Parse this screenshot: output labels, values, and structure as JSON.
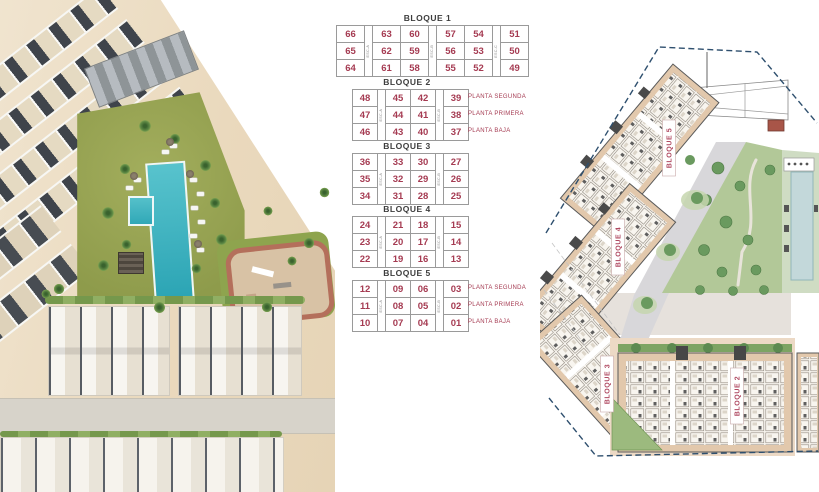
{
  "tables": {
    "blocks": [
      {
        "name": "BLOQUE 1",
        "stairs": [
          "ESC-A",
          "ESC-B",
          "ESC-C"
        ],
        "stair_after": [
          0,
          2,
          4
        ],
        "rows": [
          [
            "66",
            "63",
            "60",
            "57",
            "54",
            "51"
          ],
          [
            "65",
            "62",
            "59",
            "56",
            "53",
            "50"
          ],
          [
            "64",
            "61",
            "58",
            "55",
            "52",
            "49"
          ]
        ],
        "floor_labels": []
      },
      {
        "name": "BLOQUE 2",
        "stairs": [
          "ESC-A",
          "ESC-B"
        ],
        "stair_after": [
          0,
          2
        ],
        "rows": [
          [
            "48",
            "45",
            "42",
            "39"
          ],
          [
            "47",
            "44",
            "41",
            "38"
          ],
          [
            "46",
            "43",
            "40",
            "37"
          ]
        ],
        "floor_labels": [
          "PLANTA SEGUNDA",
          "PLANTA PRIMERA",
          "PLANTA BAJA"
        ]
      },
      {
        "name": "BLOQUE 3",
        "stairs": [
          "ESC-A",
          "ESC-B"
        ],
        "stair_after": [
          0,
          2
        ],
        "rows": [
          [
            "36",
            "33",
            "30",
            "27"
          ],
          [
            "35",
            "32",
            "29",
            "26"
          ],
          [
            "34",
            "31",
            "28",
            "25"
          ]
        ],
        "floor_labels": []
      },
      {
        "name": "BLOQUE 4",
        "stairs": [
          "ESC-A",
          "ESC-B"
        ],
        "stair_after": [
          0,
          2
        ],
        "rows": [
          [
            "24",
            "21",
            "18",
            "15"
          ],
          [
            "23",
            "20",
            "17",
            "14"
          ],
          [
            "22",
            "19",
            "16",
            "13"
          ]
        ],
        "floor_labels": []
      },
      {
        "name": "BLOQUE 5",
        "stairs": [
          "ESC-A",
          "ESC-B"
        ],
        "stair_after": [
          0,
          2
        ],
        "rows": [
          [
            "12",
            "09",
            "06",
            "03"
          ],
          [
            "11",
            "08",
            "05",
            "02"
          ],
          [
            "10",
            "07",
            "04",
            "01"
          ]
        ],
        "floor_labels": [
          "PLANTA SEGUNDA",
          "PLANTA PRIMERA",
          "PLANTA BAJA"
        ]
      }
    ]
  },
  "plan": {
    "block_labels": [
      "BLOQUE 5",
      "BLOQUE 4",
      "BLOQUE 3",
      "BLOQUE 2"
    ]
  },
  "colors": {
    "unit_number": "#a53b52",
    "block_title": "#3d3d3d",
    "table_border": "#9a9a9a",
    "floor_label": "#a53b52",
    "plan_label": "#b04a62",
    "plan_boundary": "#2e4f6e",
    "plan_building": "#e2c8ac",
    "plan_garden": "#b2c898",
    "plan_pool": "#c3d8da",
    "render_lawn": "#96a151",
    "render_pool": "#35aebd",
    "render_ground": "#ead9bd"
  }
}
